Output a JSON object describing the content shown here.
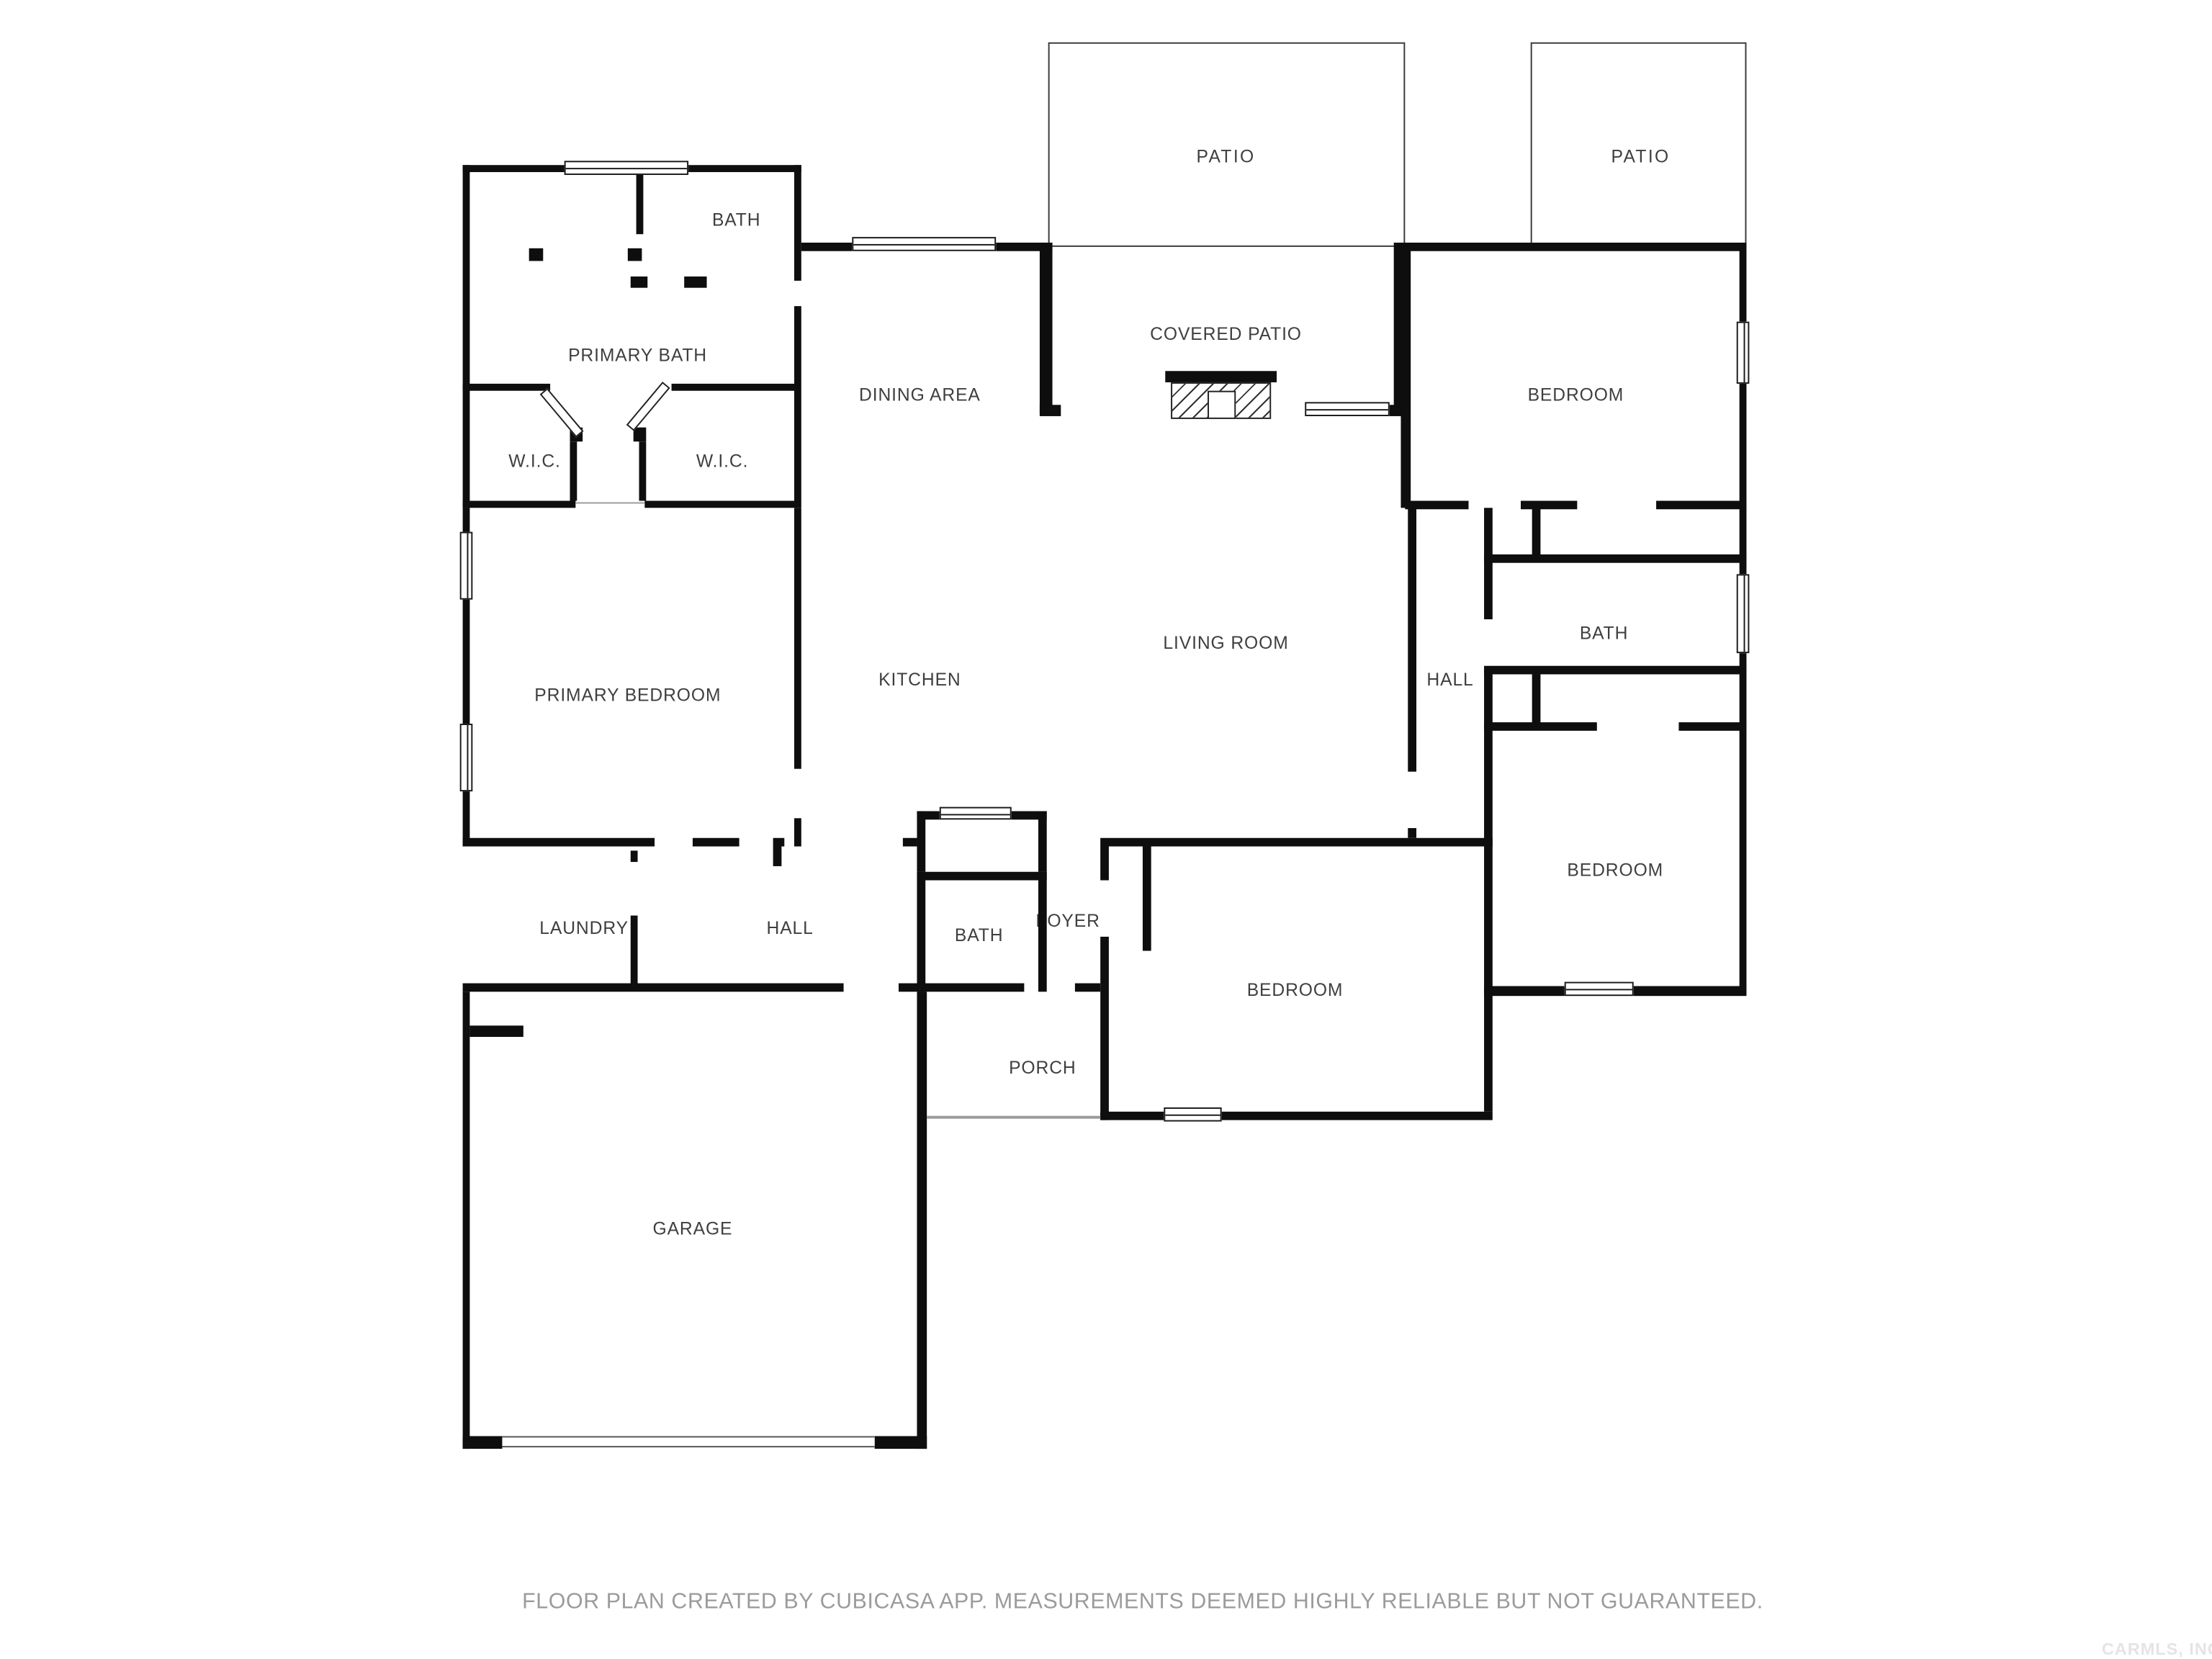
{
  "plan": {
    "rooms": [
      {
        "id": "patio-left",
        "label": "PATIO"
      },
      {
        "id": "patio-right",
        "label": "PATIO"
      },
      {
        "id": "bath-topleft",
        "label": "BATH"
      },
      {
        "id": "primary-bath",
        "label": "PRIMARY BATH"
      },
      {
        "id": "dining-area",
        "label": "DINING AREA"
      },
      {
        "id": "covered-patio",
        "label": "COVERED PATIO"
      },
      {
        "id": "bedroom-topright",
        "label": "BEDROOM"
      },
      {
        "id": "wic-left",
        "label": "W.I.C."
      },
      {
        "id": "wic-right",
        "label": "W.I.C."
      },
      {
        "id": "primary-bedroom",
        "label": "PRIMARY BEDROOM"
      },
      {
        "id": "kitchen",
        "label": "KITCHEN"
      },
      {
        "id": "living-room",
        "label": "LIVING ROOM"
      },
      {
        "id": "hall-right",
        "label": "HALL"
      },
      {
        "id": "bath-right",
        "label": "BATH"
      },
      {
        "id": "bedroom-right",
        "label": "BEDROOM"
      },
      {
        "id": "laundry",
        "label": "LAUNDRY"
      },
      {
        "id": "hall-bottom",
        "label": "HALL"
      },
      {
        "id": "bath-bottom",
        "label": "BATH"
      },
      {
        "id": "foyer",
        "label": "FOYER"
      },
      {
        "id": "bedroom-center",
        "label": "BEDROOM"
      },
      {
        "id": "porch",
        "label": "PORCH"
      },
      {
        "id": "garage",
        "label": "GARAGE"
      }
    ]
  },
  "footer": {
    "text": "FLOOR PLAN CREATED BY CUBICASA APP. MEASUREMENTS DEEMED HIGHLY RELIABLE BUT NOT GUARANTEED."
  },
  "watermark": {
    "text": "CARMLS, INC"
  },
  "colors": {
    "wall": "#0e0e0e",
    "label": "#3f3f3f",
    "footer": "#9b9b9b",
    "watermark": "#e4e4e4"
  }
}
